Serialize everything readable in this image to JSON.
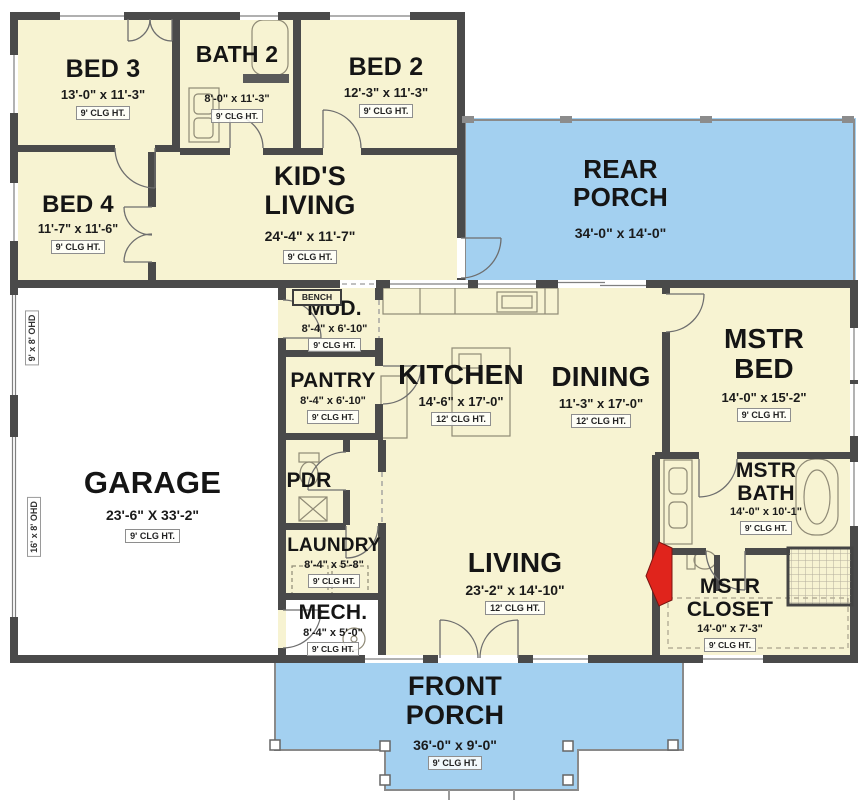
{
  "rooms": {
    "bed3": {
      "name": "BED 3",
      "dims": "13'-0\" x 11'-3\"",
      "clg": "9' CLG HT."
    },
    "bath2": {
      "name": "BATH 2",
      "dims": "8'-0\" x 11'-3\"",
      "clg": "9' CLG HT."
    },
    "bed2": {
      "name": "BED 2",
      "dims": "12'-3\" x 11'-3\"",
      "clg": "9' CLG HT."
    },
    "bed4": {
      "name": "BED 4",
      "dims": "11'-7\" x 11'-6\"",
      "clg": "9' CLG HT."
    },
    "kids_living": {
      "name": "KID'S LIVING",
      "dims": "24'-4\" x 11'-7\"",
      "clg": "9' CLG HT."
    },
    "rear_porch": {
      "name": "REAR PORCH",
      "dims": "34'-0\" x 14'-0\""
    },
    "garage": {
      "name": "GARAGE",
      "dims": "23'-6\" X 33'-2\"",
      "clg": "9' CLG HT."
    },
    "mud": {
      "name": "MUD.",
      "dims": "8'-4\" x 6'-10\"",
      "clg": "9' CLG HT."
    },
    "pantry": {
      "name": "PANTRY",
      "dims": "8'-4\" x 6'-10\"",
      "clg": "9' CLG HT."
    },
    "kitchen": {
      "name": "KITCHEN",
      "dims": "14'-6\" x 17'-0\"",
      "clg": "12' CLG HT."
    },
    "dining": {
      "name": "DINING",
      "dims": "11'-3\" x 17'-0\"",
      "clg": "12' CLG HT."
    },
    "mstr_bed": {
      "name": "MSTR BED",
      "dims": "14'-0\" x 15'-2\"",
      "clg": "9' CLG HT."
    },
    "pdr": {
      "name": "PDR"
    },
    "laundry": {
      "name": "LAUNDRY",
      "dims": "8'-4\" x 5'-8\"",
      "clg": "9' CLG HT."
    },
    "mech": {
      "name": "MECH.",
      "dims": "8'-4\" x 5'-0\"",
      "clg": "9' CLG HT."
    },
    "living": {
      "name": "LIVING",
      "dims": "23'-2\" x 14'-10\"",
      "clg": "12' CLG HT."
    },
    "mstr_bath": {
      "name": "MSTR BATH",
      "dims": "14'-0\" x 10'-1\"",
      "clg": "9' CLG HT."
    },
    "mstr_closet": {
      "name": "MSTR CLOSET",
      "dims": "14'-0\" x 7'-3\"",
      "clg": "9' CLG HT."
    },
    "front_porch": {
      "name": "FRONT PORCH",
      "dims": "36'-0\" x 9'-0\"",
      "clg": "9' CLG HT."
    }
  },
  "annotations": {
    "bench": "BENCH",
    "ohd_small": "9' x 8' OHD",
    "ohd_large": "16' x 8' OHD"
  },
  "colors": {
    "room_fill": "#F7F3D2",
    "porch_fill": "#A3D0F0",
    "wall": "#4A4A4A",
    "garage_fill": "#FFFFFF",
    "fireplace": "#E0241C"
  }
}
